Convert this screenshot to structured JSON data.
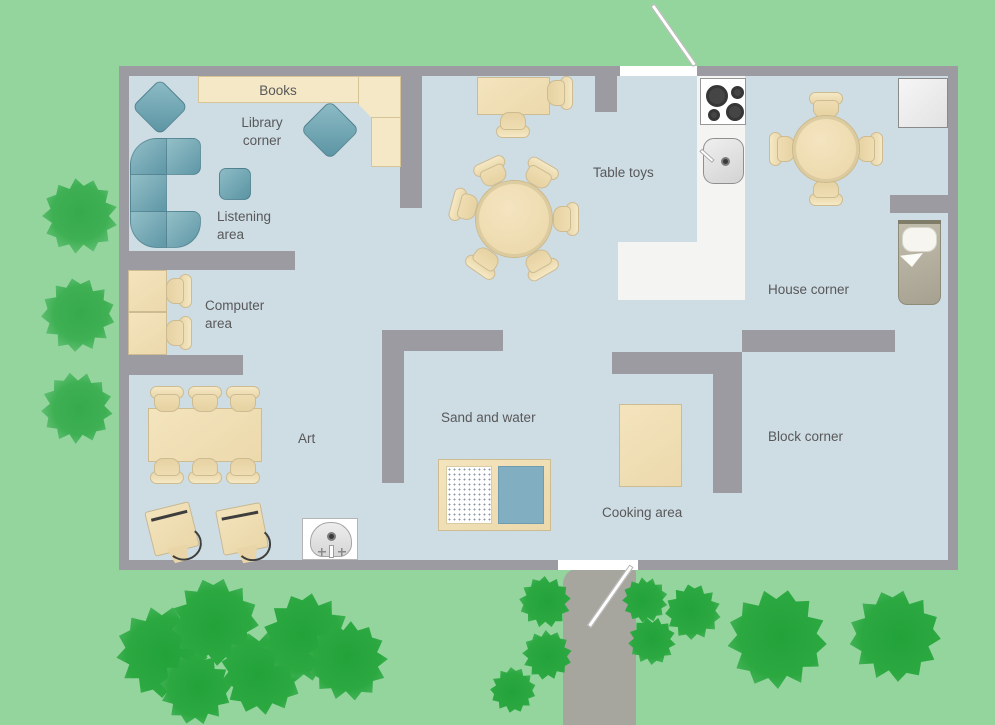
{
  "plan": {
    "title": "Classroom floor plan",
    "areas": {
      "books": "Books",
      "library_corner": "Library\ncorner",
      "listening_area": "Listening\narea",
      "computer_area": "Computer\narea",
      "art": "Art",
      "sand_and_water": "Sand and water",
      "table_toys": "Table toys",
      "cooking_area": "Cooking area",
      "block_corner": "Block corner",
      "house_corner": "House corner"
    }
  },
  "colors": {
    "grass": "#93d59d",
    "floor": "#cedde4",
    "wall": "#9b9ba1",
    "kitchenFloor": "#f4f4f3",
    "furnitureBorder": "#cdbb92",
    "shelf": "#f5e8c6",
    "water": "#82aec1",
    "path": "#a7a69e",
    "labelText": "#58585a"
  }
}
